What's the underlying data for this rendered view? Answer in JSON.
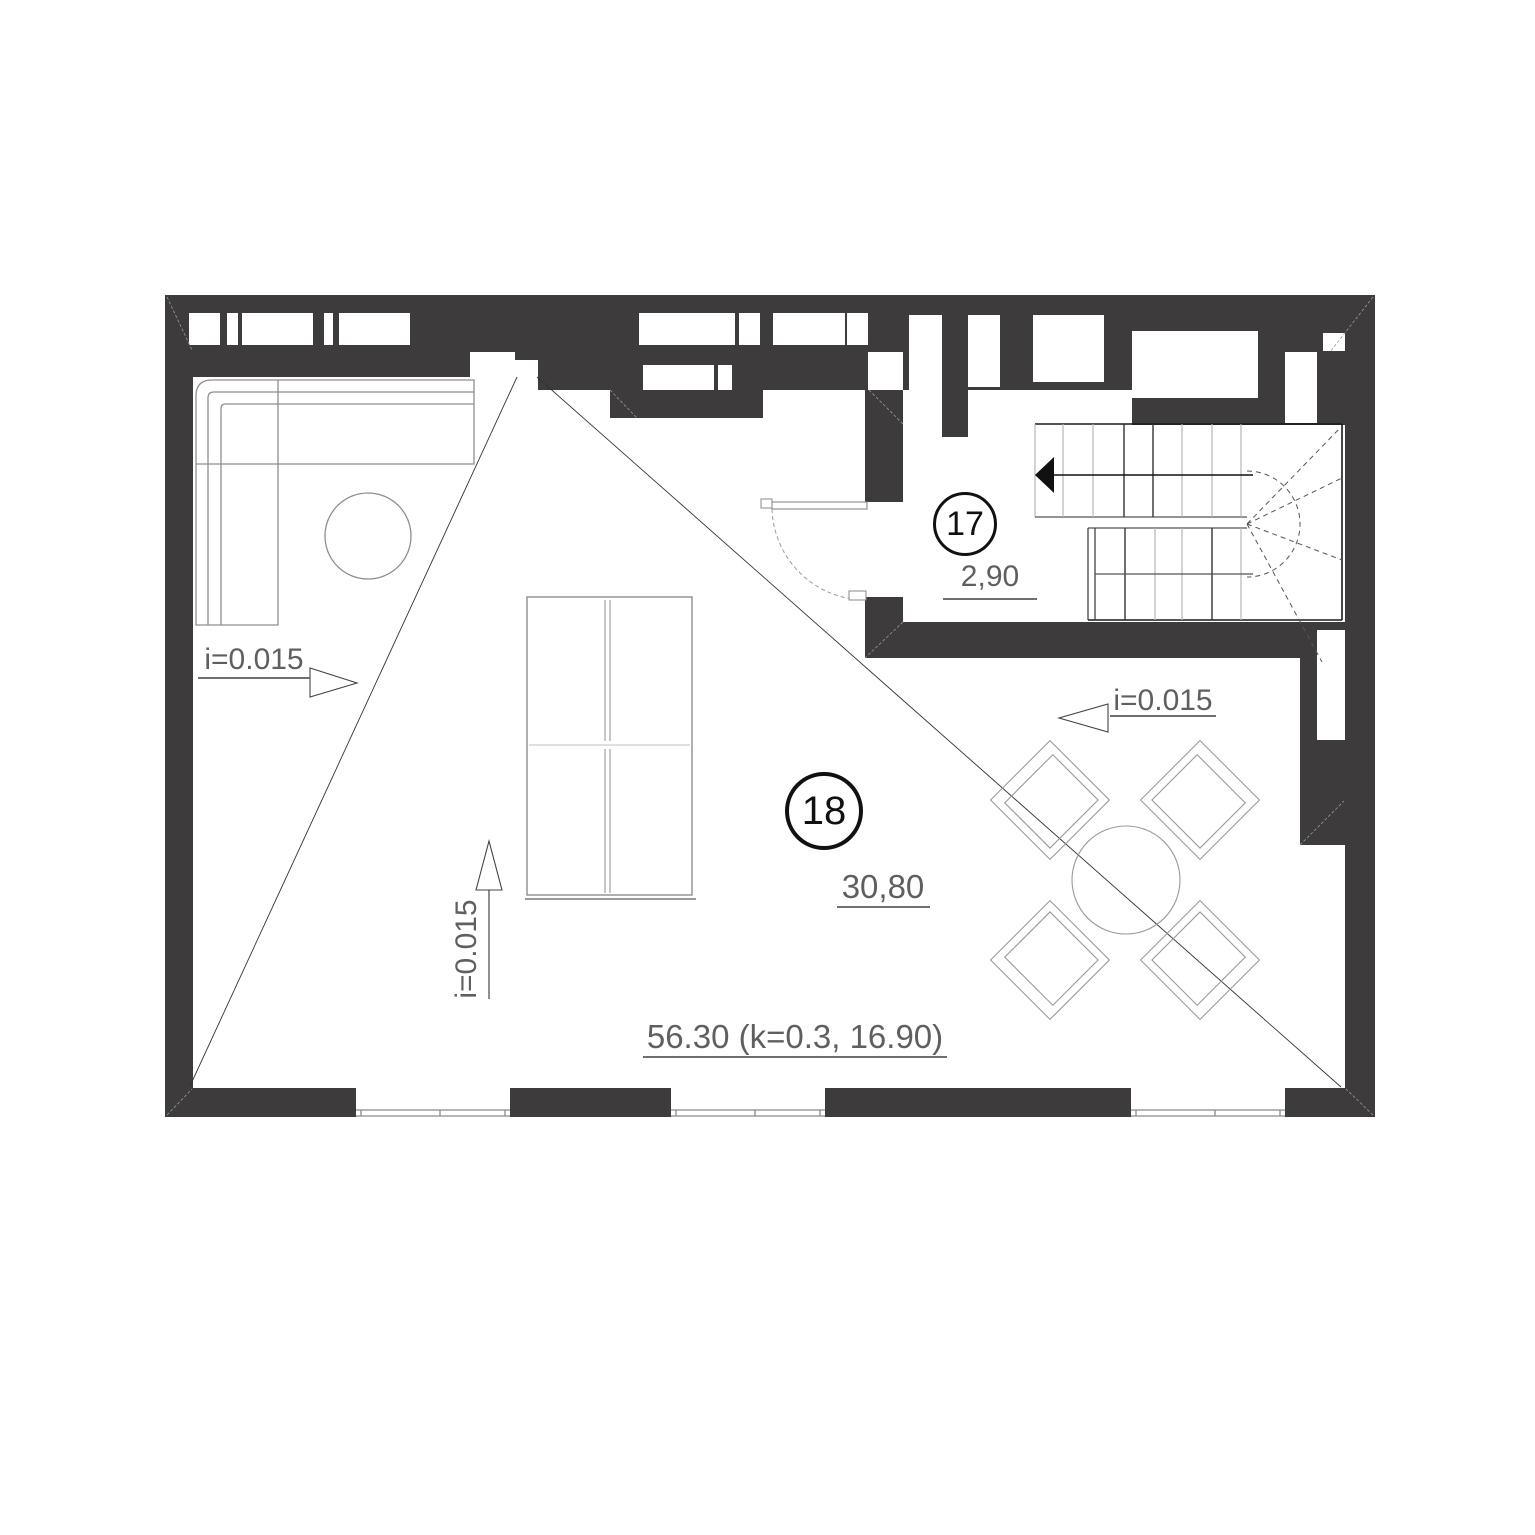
{
  "drawing": {
    "type": "architectural floor plan",
    "rooms": [
      {
        "number": "17",
        "area": "2,90"
      },
      {
        "number": "18",
        "area": "30,80"
      }
    ],
    "total_label": "56.30 (k=0.3, 16.90)",
    "slope_left": "i=0.015",
    "slope_middle": "i=0.015",
    "slope_right": "i=0.015",
    "colors": {
      "wall": "#3e3b3c",
      "stair_line": "#1a1a1a",
      "furniture_line": "#8f8f8f",
      "dimension_text": "#5f5f5f",
      "room_number_text": "#111111"
    }
  }
}
